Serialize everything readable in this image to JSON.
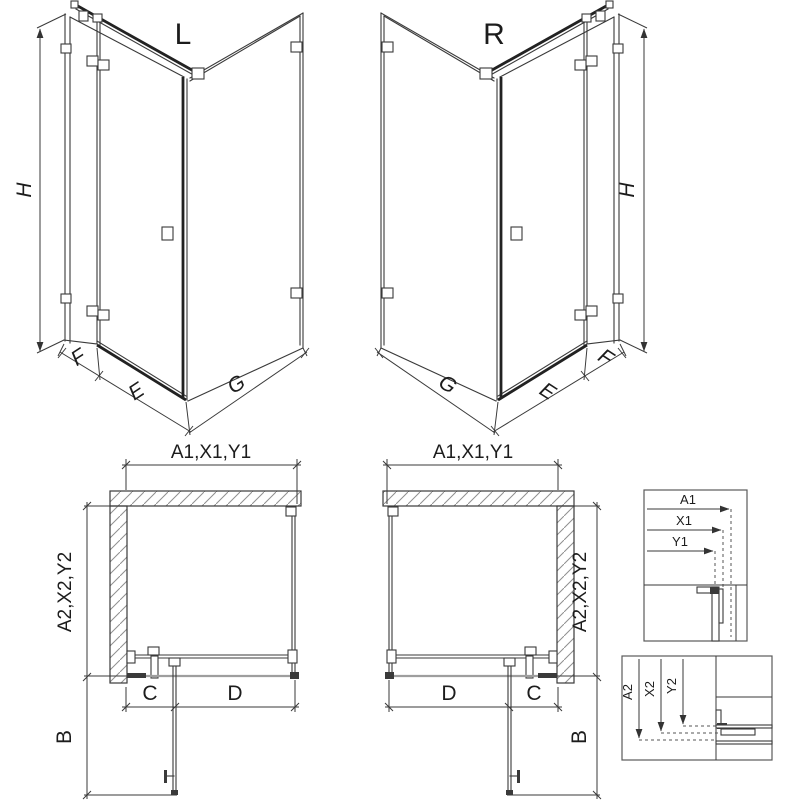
{
  "iso_left": {
    "title": "L",
    "dim_h": "H",
    "dim_f": "F",
    "dim_e": "E",
    "dim_g": "G"
  },
  "iso_right": {
    "title": "R",
    "dim_h": "H",
    "dim_f": "F",
    "dim_e": "E",
    "dim_g": "G"
  },
  "plan_left": {
    "dim_top": "A1,X1,Y1",
    "dim_side": "A2,X2,Y2",
    "dim_c": "C",
    "dim_d": "D",
    "dim_b": "B"
  },
  "plan_right": {
    "dim_top": "A1,X1,Y1",
    "dim_side": "A2,X2,Y2",
    "dim_c": "C",
    "dim_d": "D",
    "dim_b": "B"
  },
  "detail_top": {
    "label_a1": "A1",
    "label_x1": "X1",
    "label_y1": "Y1"
  },
  "detail_bottom": {
    "label_a2": "A2",
    "label_x2": "X2",
    "label_y2": "Y2"
  },
  "colors": {
    "line": "#3a3a3a",
    "line_dark": "#222222",
    "line_gray": "#9e9e9e",
    "text": "#1c1c1c",
    "background": "#ffffff"
  }
}
